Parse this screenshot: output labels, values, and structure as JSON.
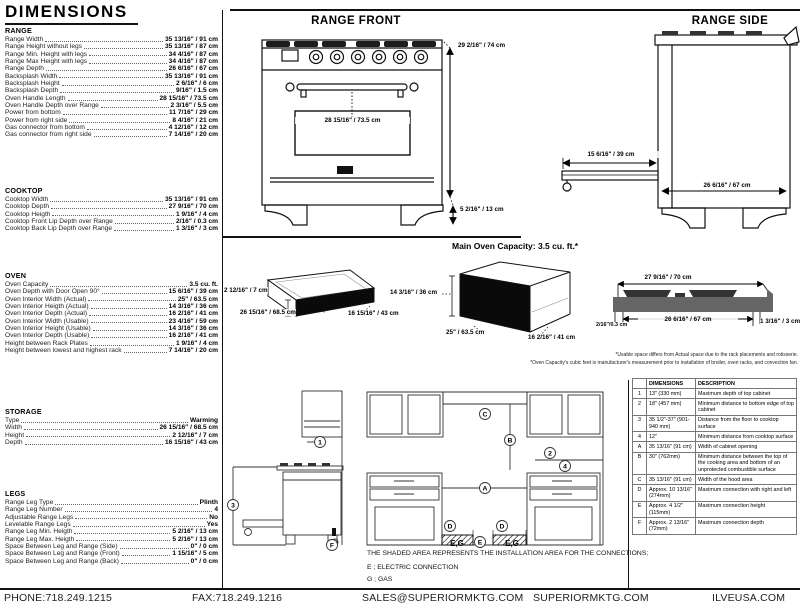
{
  "header": {
    "title": "DIMENSIONS"
  },
  "sections": {
    "range": {
      "title": "RANGE",
      "rows": [
        {
          "label": "Range Width",
          "value": "35 13/16\" / 91 cm"
        },
        {
          "label": "Range Height without legs",
          "value": "35 13/16\" / 87 cm"
        },
        {
          "label": "Range Min. Height with legs",
          "value": "34 4/16\" / 87 cm"
        },
        {
          "label": "Range Max Height with legs",
          "value": "34 4/16\" / 87 cm"
        },
        {
          "label": "Range Depth",
          "value": "26 6/16\" / 67 cm"
        },
        {
          "label": "Backsplash Width",
          "value": "35 13/16\" / 91 cm"
        },
        {
          "label": "Backsplash Height",
          "value": "2 6/16\" / 6 cm"
        },
        {
          "label": "Backsplash Depth",
          "value": "9/16\" / 1.5 cm"
        },
        {
          "label": "Oven Handle Length",
          "value": "28 15/16\" / 73.5 cm"
        },
        {
          "label": "Oven Handle Depth over Range",
          "value": "2 3/16\" / 5.5 cm"
        },
        {
          "label": "Power from bottom",
          "value": "11 7/16\" / 29 cm"
        },
        {
          "label": "Power from right side",
          "value": "8 4/16\" / 21 cm"
        },
        {
          "label": "Gas connector from bottom",
          "value": "4 12/16\" / 12 cm"
        },
        {
          "label": "Gas connector from right side",
          "value": "7 14/16\" / 20 cm"
        }
      ]
    },
    "cooktop": {
      "title": "COOKTOP",
      "rows": [
        {
          "label": "Cooktop Width",
          "value": "35 13/16\" / 91 cm"
        },
        {
          "label": "Cooktop Depth",
          "value": "27 9/16\" / 70 cm"
        },
        {
          "label": "Cooktop Heigth",
          "value": "1 9/16\" / 4 cm"
        },
        {
          "label": "Cooktop Front Lip Depth over Range",
          "value": "2/16\" / 0.3 cm"
        },
        {
          "label": "Cooktop Back Lip Depth over Range",
          "value": "1 3/16\" / 3 cm"
        }
      ]
    },
    "oven": {
      "title": "OVEN",
      "rows": [
        {
          "label": "Oven Capacity",
          "value": "3.5 cu. ft."
        },
        {
          "label": "Oven Depth with Door Open 90°",
          "value": "15 6/16\" / 39 cm"
        },
        {
          "label": "Oven Interior Width (Actual)",
          "value": "25\" / 63.5 cm"
        },
        {
          "label": "Oven Interior Heigth (Actual)",
          "value": "14 3/16\" / 36 cm"
        },
        {
          "label": "Oven Interior Depth (Actual)",
          "value": "16 2/16\" / 41 cm"
        },
        {
          "label": "Oven Interior Width (Usable)",
          "value": "23 4/16\" / 59 cm"
        },
        {
          "label": "Oven Interior Height (Usable)",
          "value": "14 3/16\" / 36 cm"
        },
        {
          "label": "Oven Interior Depth (Usable)",
          "value": "16 2/16\" / 41 cm"
        },
        {
          "label": "Height between Rack Plates",
          "value": "1 9/16\" / 4 cm"
        },
        {
          "label": "Height between lowest and highest rack",
          "value": "7 14/16\" / 20 cm"
        }
      ]
    },
    "storage": {
      "title": "STORAGE",
      "rows": [
        {
          "label": "Type",
          "value": "Warming"
        },
        {
          "label": "Width",
          "value": "26 15/16\" / 68.5 cm"
        },
        {
          "label": "Height",
          "value": "2 12/16\" / 7 cm"
        },
        {
          "label": "Depth",
          "value": "16 15/16\" / 43 cm"
        }
      ]
    },
    "legs": {
      "title": "LEGS",
      "rows": [
        {
          "label": "Range Leg Type",
          "value": "Plinth"
        },
        {
          "label": "Range Leg Number",
          "value": "4"
        },
        {
          "label": "Adjustable Range Legs",
          "value": "No"
        },
        {
          "label": "Levelable Range Legs",
          "value": "Yes"
        },
        {
          "label": "Range Leg Min. Heigth",
          "value": "5 2/16\" / 13 cm"
        },
        {
          "label": "Range Leg Max. Heigth",
          "value": "5 2/16\" / 13 cm"
        },
        {
          "label": "Space Between Leg and Range (Side)",
          "value": "0\" / 0 cm"
        },
        {
          "label": "Space Between Leg and Range (Front)",
          "value": "1 15/16\" / 5 cm"
        },
        {
          "label": "Space Between Leg and Range (Back)",
          "value": "0\" / 0 cm"
        }
      ]
    }
  },
  "range_front": {
    "title": "RANGE FRONT",
    "overall_height": "29 2/16\" / 74 cm",
    "handle_length": "28 15/16\" / 73.5 cm",
    "leg_height": "5 2/16\" / 13 cm"
  },
  "range_side": {
    "title": "RANGE SIDE",
    "door_open_depth": "15 6/16\" / 39 cm",
    "body_depth": "26 6/16\" / 67 cm"
  },
  "storage_drawer": {
    "height": "2 12/16\" / 7 cm",
    "width": "26 15/16\" / 68.5 cm",
    "depth": "16 15/16\" / 43 cm"
  },
  "main_oven": {
    "heading": "Main Oven Capacity: 3.5 cu. ft.*",
    "height": "14 3/16\" / 36 cm",
    "width": "25\" / 63.5 cm",
    "depth": "16 2/16\" / 41 cm"
  },
  "cooktop_profile": {
    "width": "27 9/16\" / 70 cm",
    "inner_width": "26 6/16\" / 67 cm",
    "front_lip": "2/16\"/0.3 cm",
    "back_lip": "1 3/16\" / 3 cm"
  },
  "footnotes": {
    "line1": "*Usable space differs from Actual space due to the rack placements and rotisserie.",
    "line2": "*Oven Capacity's cubic feet is manufacturer's measurement prior to installation of broiler, oven racks, and convection fan."
  },
  "installation": {
    "note": "THE SHADED AREA REPRESENTS THE INSTALLATION AREA FOR THE CONNECTIONS;",
    "electric": "E ; ELECTRIC CONNECTION",
    "gas": "G ; GAS",
    "eg": "E,G",
    "callouts": {
      "c1": "1",
      "c2": "2",
      "c3": "3",
      "c4": "4",
      "ca": "A",
      "cb": "B",
      "cc": "C",
      "cd": "D",
      "ce": "E",
      "cf": "F"
    }
  },
  "spec_table": {
    "col_dim": "DIMENSIONS",
    "col_desc": "DESCRIPTION",
    "rows": [
      [
        "1",
        "13\" (330 mm)",
        "Maximum depth of top cabinet"
      ],
      [
        "2",
        "18\" (457 mm)",
        "Minimum distance to bottom edge of top cabinet"
      ],
      [
        "3",
        "35 1/2\"-37\" (901-940 mm)",
        "Distance from the floor to cooktop surface"
      ],
      [
        "4",
        "12\"",
        "Minimum distance from cooktop surface"
      ],
      [
        "A",
        "35 13/16\" (91 cm)",
        "Width of cabinet opening"
      ],
      [
        "B",
        "30\" (762mm)",
        "Minimum distance between the top of the cooking area and bottom of an unprotected combustible surface"
      ],
      [
        "C",
        "35 13/16\" (91 cm)",
        "Width of the hood area"
      ],
      [
        "D",
        "Approx. 10 13/16\" (274mm)",
        "Maximum connection with right and left"
      ],
      [
        "E",
        "Approx. 4 1/2\" (115mm)",
        "Maximum connection height"
      ],
      [
        "F",
        "Approx. 2 13/16\" (72mm)",
        "Maximum connection depth"
      ]
    ]
  },
  "footer": {
    "phone": "PHONE:718.249.1215",
    "fax": "FAX:718.249.1216",
    "email": "SALES@SUPERIORMKTG.COM",
    "website": "SUPERIORMKTG.COM",
    "website2": "ILVEUSA.COM"
  }
}
